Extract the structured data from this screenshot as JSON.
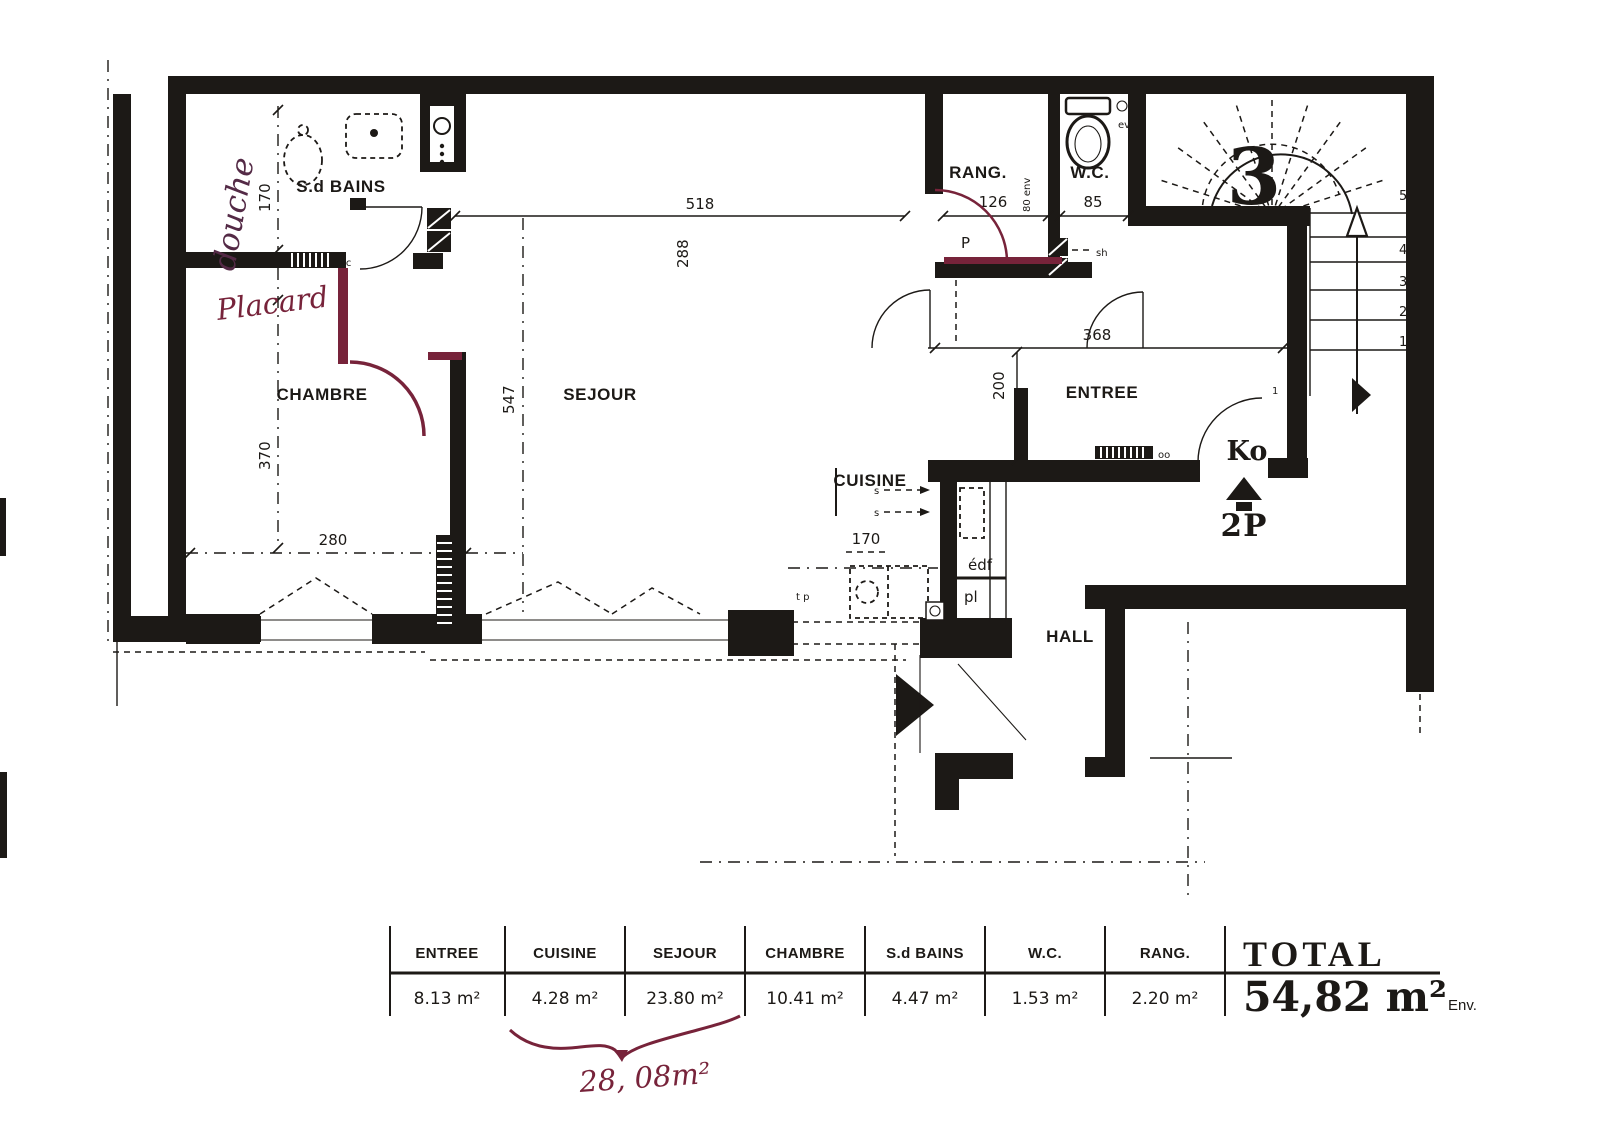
{
  "doc": {
    "colors": {
      "paper": "#ffffff",
      "ink": "#1c1916",
      "red": "#77233a"
    }
  },
  "plan": {
    "rooms": {
      "sdbains": "S.d BAINS",
      "chambre": "CHAMBRE",
      "sejour": "SEJOUR",
      "cuisine": "CUISINE",
      "entree": "ENTREE",
      "rang": "RANG.",
      "wc": "W.C.",
      "hall": "HALL"
    },
    "dims": {
      "d518": "518",
      "d288": "288",
      "d126": "126",
      "d85": "85",
      "d368": "368",
      "d200": "200",
      "d547": "547",
      "d170_bain": "170",
      "d370": "370",
      "d280": "280",
      "d170_cuisine": "170",
      "d80": "80 env"
    },
    "labels": {
      "number": "3",
      "ko": "Ko",
      "type": "2P",
      "door": "1",
      "edf": "édf",
      "pl": "pl",
      "vc": "vc",
      "oo": "oo",
      "sh": "sh",
      "p": "P",
      "ev": "ev",
      "tp": "t p",
      "s": "s"
    },
    "stairs": {
      "steps": [
        "5",
        "4",
        "3",
        "2",
        "1"
      ]
    },
    "handwritten": {
      "douche": "douche",
      "placard": "Placard",
      "area_note": "28, 08m²"
    }
  },
  "table": {
    "columns": [
      {
        "label": "ENTREE",
        "value": "8.13 m²"
      },
      {
        "label": "CUISINE",
        "value": "4.28 m²"
      },
      {
        "label": "SEJOUR",
        "value": "23.80 m²"
      },
      {
        "label": "CHAMBRE",
        "value": "10.41 m²"
      },
      {
        "label": "S.d BAINS",
        "value": "4.47 m²"
      },
      {
        "label": "W.C.",
        "value": "1.53 m²"
      },
      {
        "label": "RANG.",
        "value": "2.20 m²"
      }
    ],
    "total": {
      "label": "TOTAL",
      "value": "54,82 m²",
      "suffix": "Env."
    }
  }
}
